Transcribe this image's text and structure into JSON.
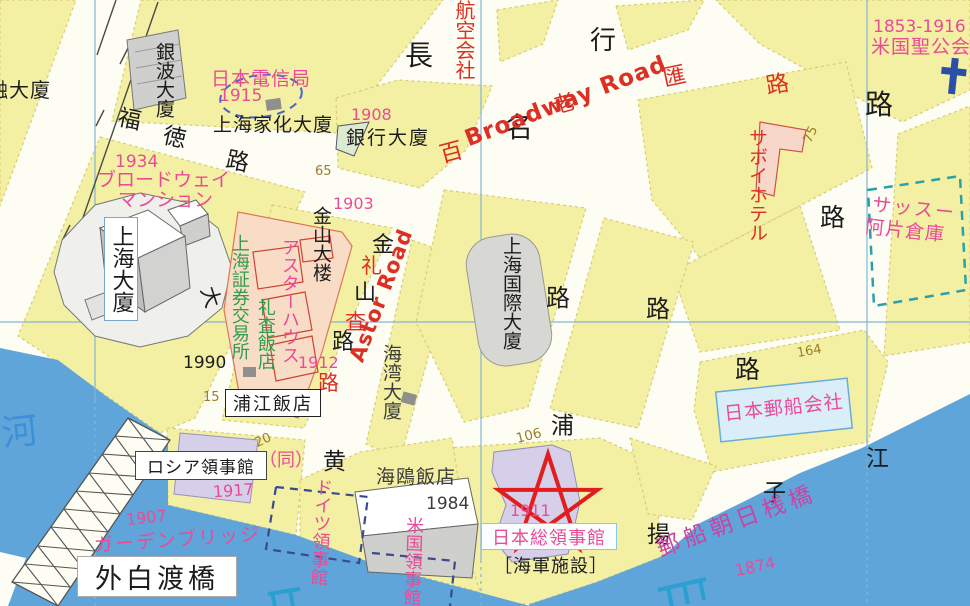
{
  "map_title": "Shanghai Hongkou riverside historical map (Japanese annotated)",
  "colors": {
    "block_yellow": "#f3efa3",
    "block_edge": "#d8cd74",
    "street_white": "#fdfdf4",
    "water_blue": "#5fa5d9",
    "grid_blue": "#85b5d6",
    "pink": "#ea4b96",
    "red": "#dd2f23",
    "green": "#2f9e4c",
    "brown": "#9b7d2a",
    "ink": "#1c1c1c",
    "navy_cross": "#2b4fa6",
    "teal_dash": "#2aa0a8",
    "navy_dash": "#3a4a90",
    "lavender": "#d6cfe9",
    "lavender_edge": "#9a91bf",
    "bldg_gray": "#d7d7d3",
    "peach": "#f8dcc6",
    "peach_edge": "#dd7755",
    "ltblue_fill": "#daeefa",
    "ltblue_edge": "#66aed8",
    "magenta": "#c944a4",
    "water_text": "#3f8fd8",
    "gray_text": "#3c3c3c",
    "star_red": "#e21d1d"
  },
  "streets": {
    "naga": "長",
    "mei": "名",
    "gyo": "行",
    "ro1": "路",
    "ro2": "路",
    "ro3": "路",
    "ro4": "路",
    "ro5": "路",
    "fuku": "福",
    "toku": "徳",
    "fuku_ro": "路",
    "kin": "金",
    "zan": "山",
    "kin_ro": "路",
    "rei": "礼",
    "sa": "査",
    "rei_ro": "路",
    "haku": "百",
    "rou": "老",
    "wai": "匯",
    "wai_ro": "路",
    "broadway_en": "Broadway Road",
    "astor_en": "Astor Road",
    "kou": "黄",
    "ho": "浦",
    "you": "揚",
    "shi": "子",
    "kiang": "江",
    "kawa": "河",
    "dai": "大"
  },
  "sites": {
    "yudaika": "融大廈",
    "ginpa": "銀波大廈",
    "denshin": "日本電信局",
    "kaka": "上海家化大廈",
    "ginko": "銀行大廈",
    "airline": "航空会社",
    "broadway_mansion_1": "ブロードウェイ",
    "broadway_mansion_2": "マンション",
    "shanghai_mansion": "上海大廈",
    "kinzan_bldg": "金山大楼",
    "shoken": "上海証券交易所",
    "astor_house": "アスターハウス",
    "reisa_hotel": "礼査飯店",
    "kaiwan": "海湾大廈",
    "kokusai": "上海国際大廈",
    "hojiang_hotel": "浦江飯店",
    "seagull_hotel": "海鴎飯店",
    "russia_consulate": "ロシア領事館",
    "russia_note": "（同）",
    "garden_bridge": "ガーデンブリッジ",
    "waibaidu_bridge": "外白渡橋",
    "germany_consulate": "ドイツ領事館",
    "usa_consulate": "米国領事館",
    "japan_consulate": "日本総領事館",
    "navy_facility": "［海軍施設］",
    "nyk": "日本郵船会社",
    "wharf": "郵船朝日桟橋",
    "savoy_hotel": "サボイホテル",
    "sassoon_1": "サッスー",
    "sassoon_2": "阿片倉庫",
    "church": "米国聖公会",
    "church_years": "1853-1916"
  },
  "years": {
    "y1915": "1915",
    "y1934": "1934",
    "y1908": "1908",
    "y1903": "1903",
    "y1912": "1912",
    "y1990": "1990",
    "y1917": "1917",
    "y1907": "1907",
    "y1984": "1984",
    "y1911": "1911",
    "y1874": "1874"
  },
  "lot_numbers": {
    "n65": "65",
    "n75": "75",
    "n15": "15",
    "n20": "20",
    "n106": "106",
    "n164": "164"
  },
  "symbols": {
    "star": "consulate-star-marker",
    "cross": "church-cross",
    "bridge": "truss-bridge",
    "piers": "wharf-pier-marks"
  }
}
